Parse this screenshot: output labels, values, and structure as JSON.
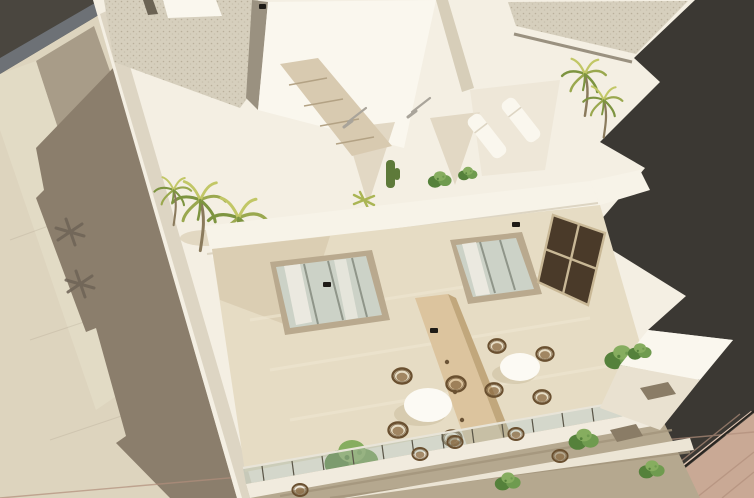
{
  "scene": {
    "kind": "aerial-3d-architectural-render",
    "subject": "white-modern-apartment-building",
    "inventory": {
      "palm_trees": 5,
      "sun_loungers": 2,
      "dining_sets": 2,
      "chairs_per_set": 4,
      "round_tables": 2,
      "bushes_planters": 6,
      "outdoor_showers": 2,
      "wall_lights": 4,
      "staircases": 1,
      "gravel_roofs": 2,
      "wood_partitions": 1,
      "dark_grid_window_panes": 4
    }
  },
  "palette": {
    "bg_dark": "#3b3833",
    "bg_corner": "#4a463f",
    "curb": "#6d7176",
    "street_cream": "#ddd4be",
    "street_cream2": "#e4dcc7",
    "street_taupe": "#a89c88",
    "street_shadow": "#8b7e6c",
    "palm_shadow": "#6e6356",
    "white_lit": "#f4efe3",
    "white_bright": "#faf7ee",
    "white_shade": "#e9e1d0",
    "deep_shade": "#cfc5ae",
    "edge_face": "#ddd5c3",
    "gravel": "#d6cfbd",
    "gravel_dot1": "#b9b09b",
    "gravel_dot2": "#c8c0ad",
    "slit_dark": "#6b6354",
    "slot_shadow": "#9a9180",
    "stair": "#d8cab0",
    "stair_line": "#b3a284",
    "parapet": "#f7f3e8",
    "terrace_floor": "#e6dcc4",
    "terrace_streak": "#efe7d2",
    "terrace_shadow": "#d5c8ac",
    "wedge_shadow": "#e2d8c4",
    "wood_partition": "#dcc49e",
    "wood_edge": "#c1a77c",
    "wood_hole": "#6b5336",
    "door_glass": "#ccd2c7",
    "door_mullion": "#8f9589",
    "door_frame": "#b9a98e",
    "curtain": "#f2efe6",
    "window_glass": "#4a3a29",
    "window_mullion": "#c9b896",
    "table_white": "#fcfaf4",
    "table_shadow": "#cbbd9f",
    "chair_stroke": "#6a5030",
    "chair_fill": "#8a6a42",
    "bush_green1": "#6f9b4f",
    "bush_green2": "#55813b",
    "bush_green3": "#86ad5f",
    "palm_green1": "#9aa84e",
    "palm_green2": "#7d9440",
    "palm_green3": "#c2c766",
    "palm_trunk": "#8a7a5c",
    "cactus": "#5e7a3a",
    "agave": "#aab554",
    "balustrade_glass": "#aebaac",
    "balustrade_post": "#5a5547",
    "balustrade_rail": "#e8e4d8",
    "lower_interior": "#b5a88f",
    "lower_streak": "#a3957c",
    "fascia": "#f1ebde",
    "ledge": "#ece5d5",
    "notch_dark": "#8a7c66",
    "brick": "#c9a995",
    "brick_line": "#b28f7c",
    "brick_highlight": "#dfc5b3",
    "brick_edge_dark": "#282520",
    "lamp_black": "#1e1b16",
    "chrome": "#a9a49a"
  }
}
